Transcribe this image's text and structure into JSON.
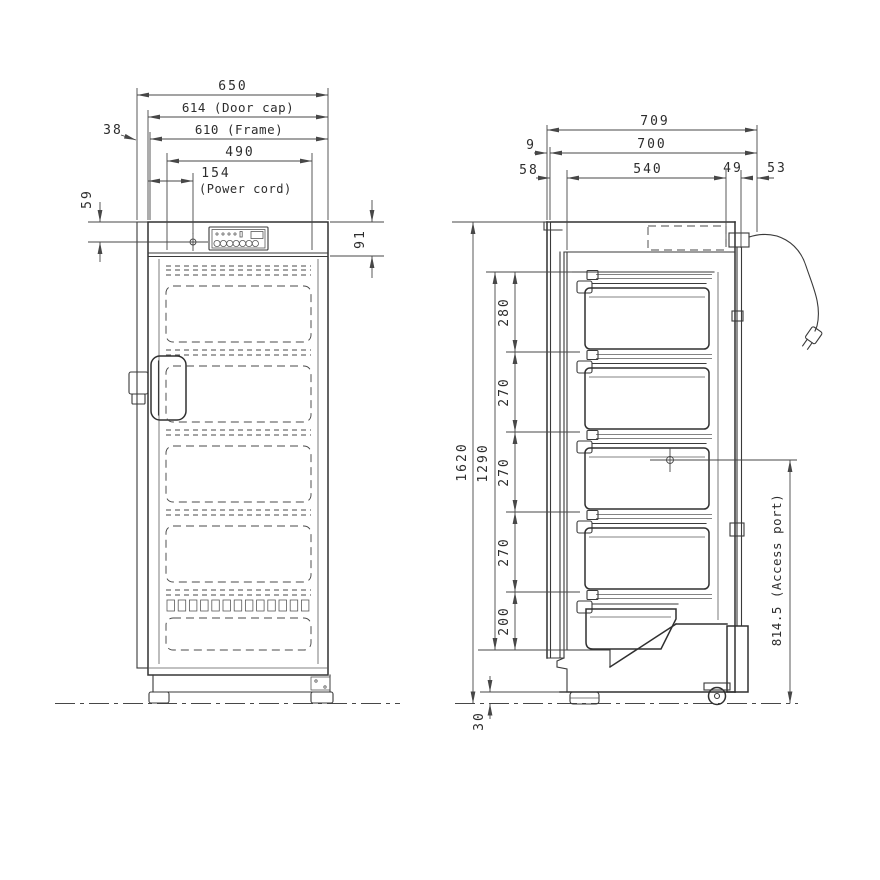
{
  "colors": {
    "line": "#3a3a3a",
    "dimension": "#474747",
    "background": "#ffffff"
  },
  "front_view": {
    "width_overall": "650",
    "width_door_cap": "614 (Door cap)",
    "width_frame": "610 (Frame)",
    "width_inner": "490",
    "power_cord_offset": "154",
    "power_cord_note": "(Power cord)",
    "hinge_side_clearance": "38",
    "power_cord_drop": "59",
    "control_panel_height": "91"
  },
  "side_view": {
    "depth_overall": "709",
    "depth_body": "700",
    "depth_interior": "540",
    "door_lip": "9",
    "door_thickness": "58",
    "rear_gap": "49",
    "rear_clearance": "53",
    "height_overall": "1620",
    "height_interior": "1290",
    "basket_pitch_1": "280",
    "basket_pitch_2": "270",
    "basket_pitch_3": "270",
    "basket_pitch_4": "270",
    "basket_pitch_5": "200",
    "ground_clearance": "30",
    "access_port_height": "814.5 (Access port)"
  }
}
